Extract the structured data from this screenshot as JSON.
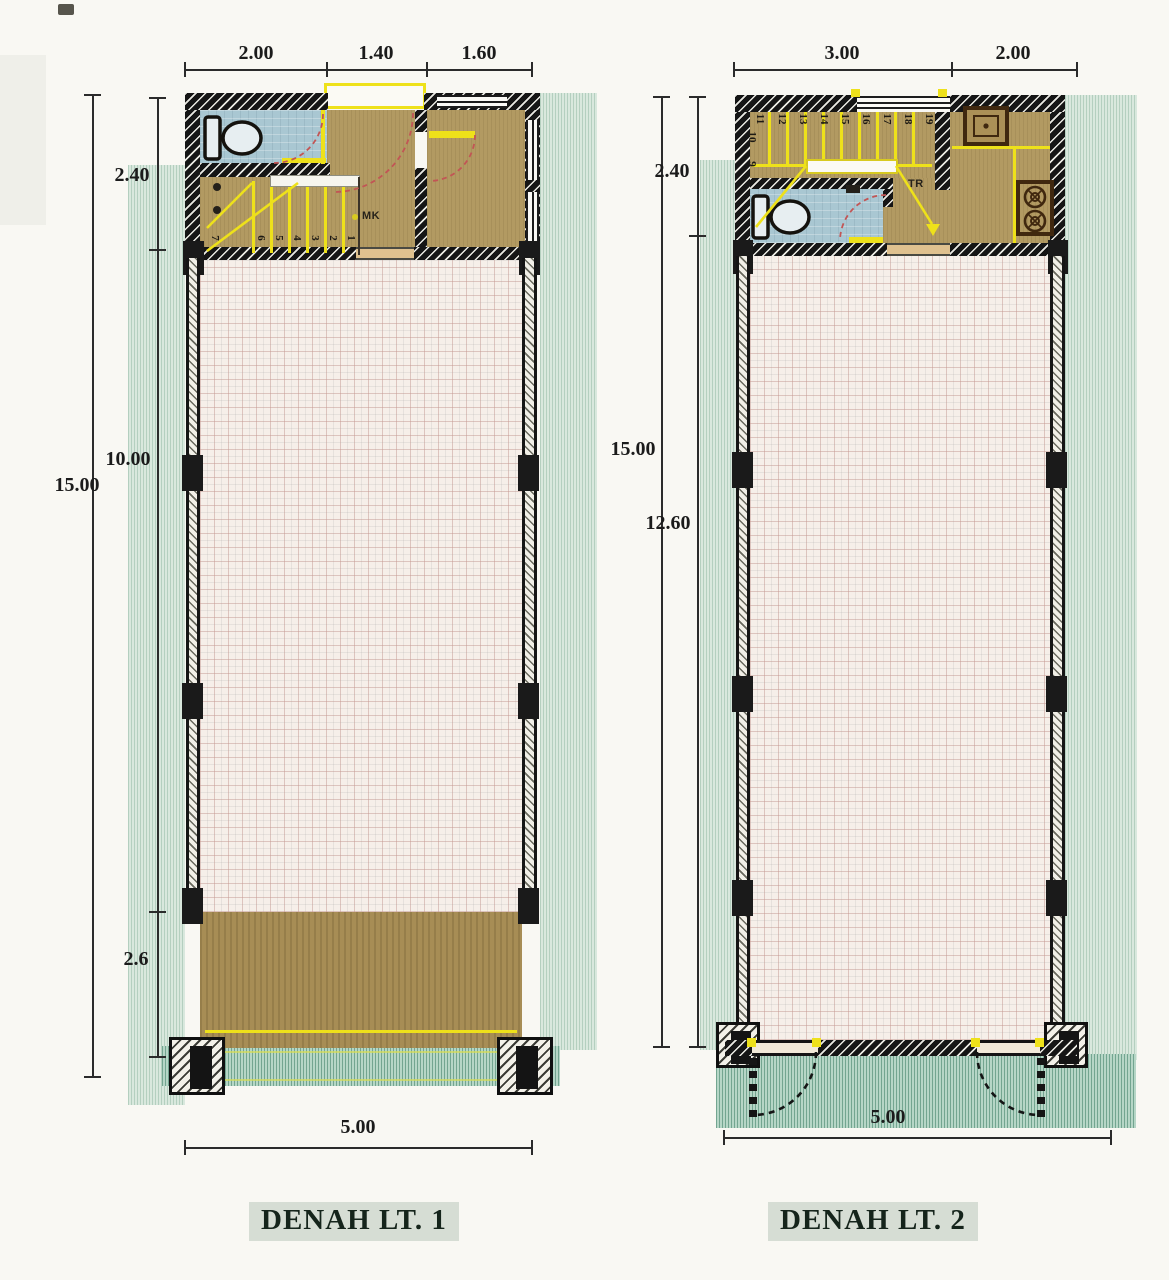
{
  "sheet": {
    "background": "#f9f8f3",
    "colors": {
      "wall": "#151515",
      "accent_yellow": "#eee11a",
      "bathroom_blue": "#a9c7d2",
      "floor_tan": "#b29a62",
      "terrace_tan": "#a78d55",
      "tile_cream": "#f6efe9",
      "site_green": "#b6d6c6",
      "swing_arc_red": "#c25555",
      "text": "#1b1b1b"
    }
  },
  "plan1": {
    "title": "DENAH LT. 1",
    "top_dims": [
      "2.00",
      "1.40",
      "1.60"
    ],
    "left_dims": [
      "2.40",
      "10.00",
      "2.6"
    ],
    "total_height": "15.00",
    "bottom_dim": "5.00",
    "stair_note": "MK",
    "stair_numbers": [
      "7",
      "6",
      "5",
      "4",
      "3",
      "2",
      "1"
    ]
  },
  "plan2": {
    "title": "DENAH LT. 2",
    "top_dims": [
      "3.00",
      "2.00"
    ],
    "left_dims": [
      "2.40",
      "12.60"
    ],
    "total_height": "15.00",
    "bottom_dim": "5.00",
    "stair_note": "TR",
    "stair_numbers_top": [
      "11",
      "12",
      "13",
      "14",
      "15",
      "16",
      "17",
      "18",
      "19"
    ],
    "stair_numbers_side": [
      "10",
      "9"
    ]
  }
}
